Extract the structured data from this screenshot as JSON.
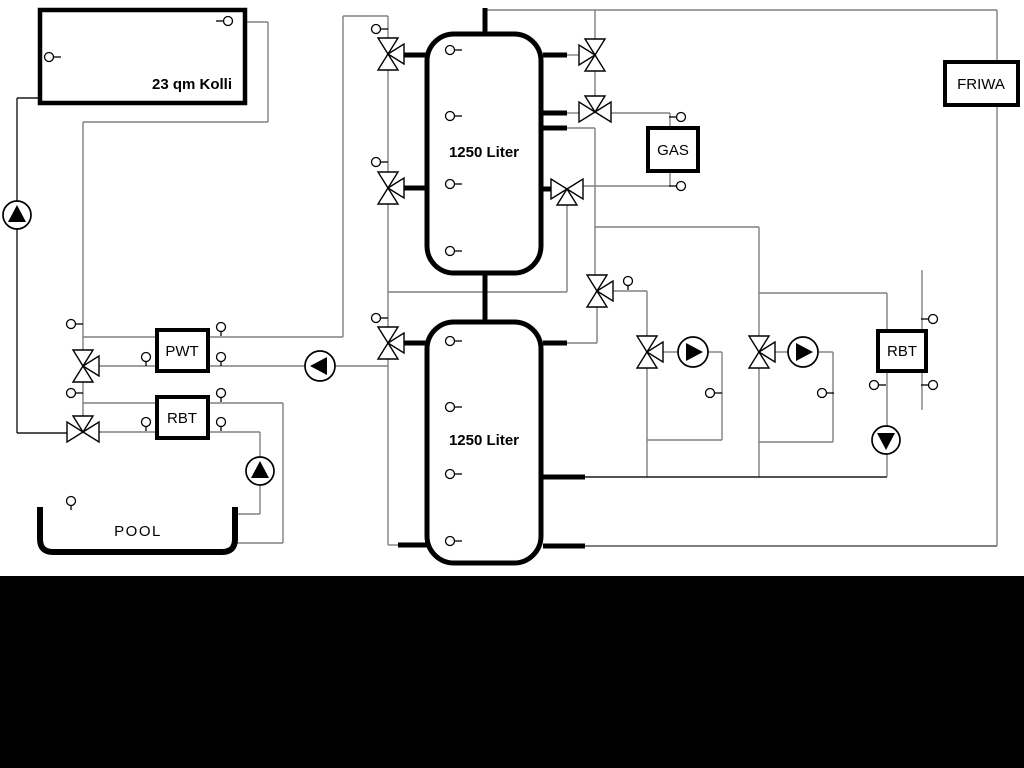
{
  "boxes": {
    "kolli": {
      "label": "23 qm Kolli"
    },
    "tank1": {
      "label": "1250 Liter"
    },
    "tank2": {
      "label": "1250 Liter"
    },
    "pwt": {
      "label": "PWT"
    },
    "rbt_left": {
      "label": "RBT"
    },
    "gas": {
      "label": "GAS"
    },
    "rbt_right": {
      "label": "RBT"
    },
    "friwa": {
      "label": "FRIWA"
    },
    "pool": {
      "label": "POOL"
    }
  },
  "colors": {
    "background": "#ffffff",
    "pipe": "#808080",
    "pipe_dark": "#1a1a1a",
    "component_stroke": "#000000",
    "bottom_bar": "#000000"
  },
  "diagram": {
    "pipes": [
      [
        17,
        98,
        17,
        433,
        "#1a1a1a"
      ],
      [
        17,
        98,
        40,
        98,
        "#1a1a1a"
      ],
      [
        17,
        433,
        67,
        433,
        "#1a1a1a"
      ],
      [
        247,
        22,
        268,
        22
      ],
      [
        268,
        22,
        268,
        122
      ],
      [
        83,
        122,
        268,
        122
      ],
      [
        83,
        122,
        83,
        351
      ],
      [
        83,
        381,
        83,
        418
      ],
      [
        83,
        337,
        157,
        337
      ],
      [
        98,
        366,
        157,
        366
      ],
      [
        83,
        403,
        157,
        403
      ],
      [
        98,
        432,
        157,
        432
      ],
      [
        208,
        337,
        343,
        337
      ],
      [
        343,
        16,
        343,
        337
      ],
      [
        343,
        16,
        388,
        16
      ],
      [
        208,
        366,
        305,
        366
      ],
      [
        335,
        366,
        388,
        366
      ],
      [
        208,
        403,
        283,
        403
      ],
      [
        283,
        403,
        283,
        543
      ],
      [
        235,
        543,
        283,
        543
      ],
      [
        208,
        432,
        260,
        432
      ],
      [
        260,
        432,
        260,
        457
      ],
      [
        260,
        485,
        260,
        514
      ],
      [
        235,
        514,
        260,
        514
      ],
      [
        388,
        16,
        388,
        38
      ],
      [
        388,
        70,
        388,
        172
      ],
      [
        388,
        204,
        388,
        327
      ],
      [
        388,
        359,
        388,
        545
      ],
      [
        388,
        545,
        402,
        545
      ],
      [
        388,
        292,
        567,
        292
      ],
      [
        567,
        205,
        567,
        292
      ],
      [
        485,
        10,
        997,
        10
      ],
      [
        595,
        10,
        595,
        39
      ],
      [
        595,
        71,
        595,
        97
      ],
      [
        567,
        55,
        579,
        55
      ],
      [
        567,
        113,
        579,
        113
      ],
      [
        611,
        113,
        670,
        113
      ],
      [
        670,
        113,
        670,
        128
      ],
      [
        670,
        171,
        670,
        186
      ],
      [
        583,
        186,
        670,
        186
      ],
      [
        567,
        128,
        595,
        128
      ],
      [
        595,
        128,
        595,
        275
      ],
      [
        595,
        227,
        759,
        227
      ],
      [
        759,
        227,
        759,
        293
      ],
      [
        759,
        293,
        887,
        293
      ],
      [
        759,
        293,
        759,
        336
      ],
      [
        613,
        291,
        647,
        291
      ],
      [
        647,
        291,
        647,
        336
      ],
      [
        597,
        307,
        597,
        343
      ],
      [
        567,
        343,
        597,
        343
      ],
      [
        663,
        352,
        678,
        352
      ],
      [
        708,
        352,
        722,
        352
      ],
      [
        722,
        352,
        722,
        440
      ],
      [
        647,
        440,
        722,
        440
      ],
      [
        647,
        368,
        647,
        477
      ],
      [
        775,
        352,
        788,
        352
      ],
      [
        818,
        352,
        833,
        352
      ],
      [
        833,
        352,
        833,
        442
      ],
      [
        759,
        442,
        833,
        442
      ],
      [
        759,
        368,
        759,
        477
      ],
      [
        585,
        477,
        887,
        477,
        "#1a1a1a"
      ],
      [
        887,
        293,
        887,
        331
      ],
      [
        887,
        371,
        887,
        426
      ],
      [
        887,
        454,
        887,
        477
      ],
      [
        922,
        270,
        922,
        410
      ],
      [
        585,
        546,
        997,
        546,
        "#555555"
      ],
      [
        997,
        10,
        997,
        546
      ]
    ],
    "stubs": [
      [
        398,
        55,
        430,
        55
      ],
      [
        398,
        188,
        430,
        188
      ],
      [
        398,
        343,
        430,
        343
      ],
      [
        398,
        545,
        430,
        545
      ],
      [
        543,
        55,
        567,
        55
      ],
      [
        543,
        113,
        567,
        113
      ],
      [
        543,
        128,
        567,
        128
      ],
      [
        543,
        189,
        555,
        189
      ],
      [
        543,
        343,
        567,
        343
      ],
      [
        543,
        477,
        585,
        477
      ],
      [
        543,
        546,
        585,
        546
      ],
      [
        485,
        8,
        485,
        34
      ],
      [
        485,
        273,
        485,
        322
      ]
    ],
    "valves": [
      [
        83,
        366,
        "UDR"
      ],
      [
        83,
        432,
        "LRU"
      ],
      [
        388,
        54,
        "UDR"
      ],
      [
        388,
        188,
        "UDR"
      ],
      [
        388,
        343,
        "UDR"
      ],
      [
        595,
        55,
        "UDL"
      ],
      [
        595,
        112,
        "LRU"
      ],
      [
        567,
        189,
        "LRD"
      ],
      [
        597,
        291,
        "UDR"
      ],
      [
        647,
        352,
        "UDR"
      ],
      [
        759,
        352,
        "UDR"
      ]
    ],
    "pumps": [
      [
        17,
        215,
        14,
        "up"
      ],
      [
        260,
        471,
        14,
        "up"
      ],
      [
        320,
        366,
        15,
        "left"
      ],
      [
        693,
        352,
        15,
        "right"
      ],
      [
        803,
        352,
        15,
        "right"
      ],
      [
        886,
        440,
        14,
        "down"
      ]
    ],
    "sensors": [
      [
        49,
        57,
        "r"
      ],
      [
        228,
        21,
        "l"
      ],
      [
        71,
        324,
        "r"
      ],
      [
        71,
        393,
        "r"
      ],
      [
        146,
        357,
        "d"
      ],
      [
        221,
        327,
        "d"
      ],
      [
        221,
        357,
        "d"
      ],
      [
        146,
        422,
        "d"
      ],
      [
        221,
        393,
        "d"
      ],
      [
        221,
        422,
        "d"
      ],
      [
        71,
        501,
        "d"
      ],
      [
        450,
        50,
        "r"
      ],
      [
        450,
        116,
        "r"
      ],
      [
        450,
        184,
        "r"
      ],
      [
        450,
        251,
        "r"
      ],
      [
        450,
        341,
        "r"
      ],
      [
        450,
        407,
        "r"
      ],
      [
        450,
        474,
        "r"
      ],
      [
        450,
        541,
        "r"
      ],
      [
        376,
        29,
        "r"
      ],
      [
        376,
        162,
        "r"
      ],
      [
        376,
        318,
        "r"
      ],
      [
        628,
        281,
        "d"
      ],
      [
        681,
        117,
        "l"
      ],
      [
        681,
        186,
        "l"
      ],
      [
        710,
        393,
        "r"
      ],
      [
        822,
        393,
        "r"
      ],
      [
        874,
        385,
        "r"
      ],
      [
        933,
        319,
        "l"
      ],
      [
        933,
        385,
        "l"
      ]
    ]
  }
}
